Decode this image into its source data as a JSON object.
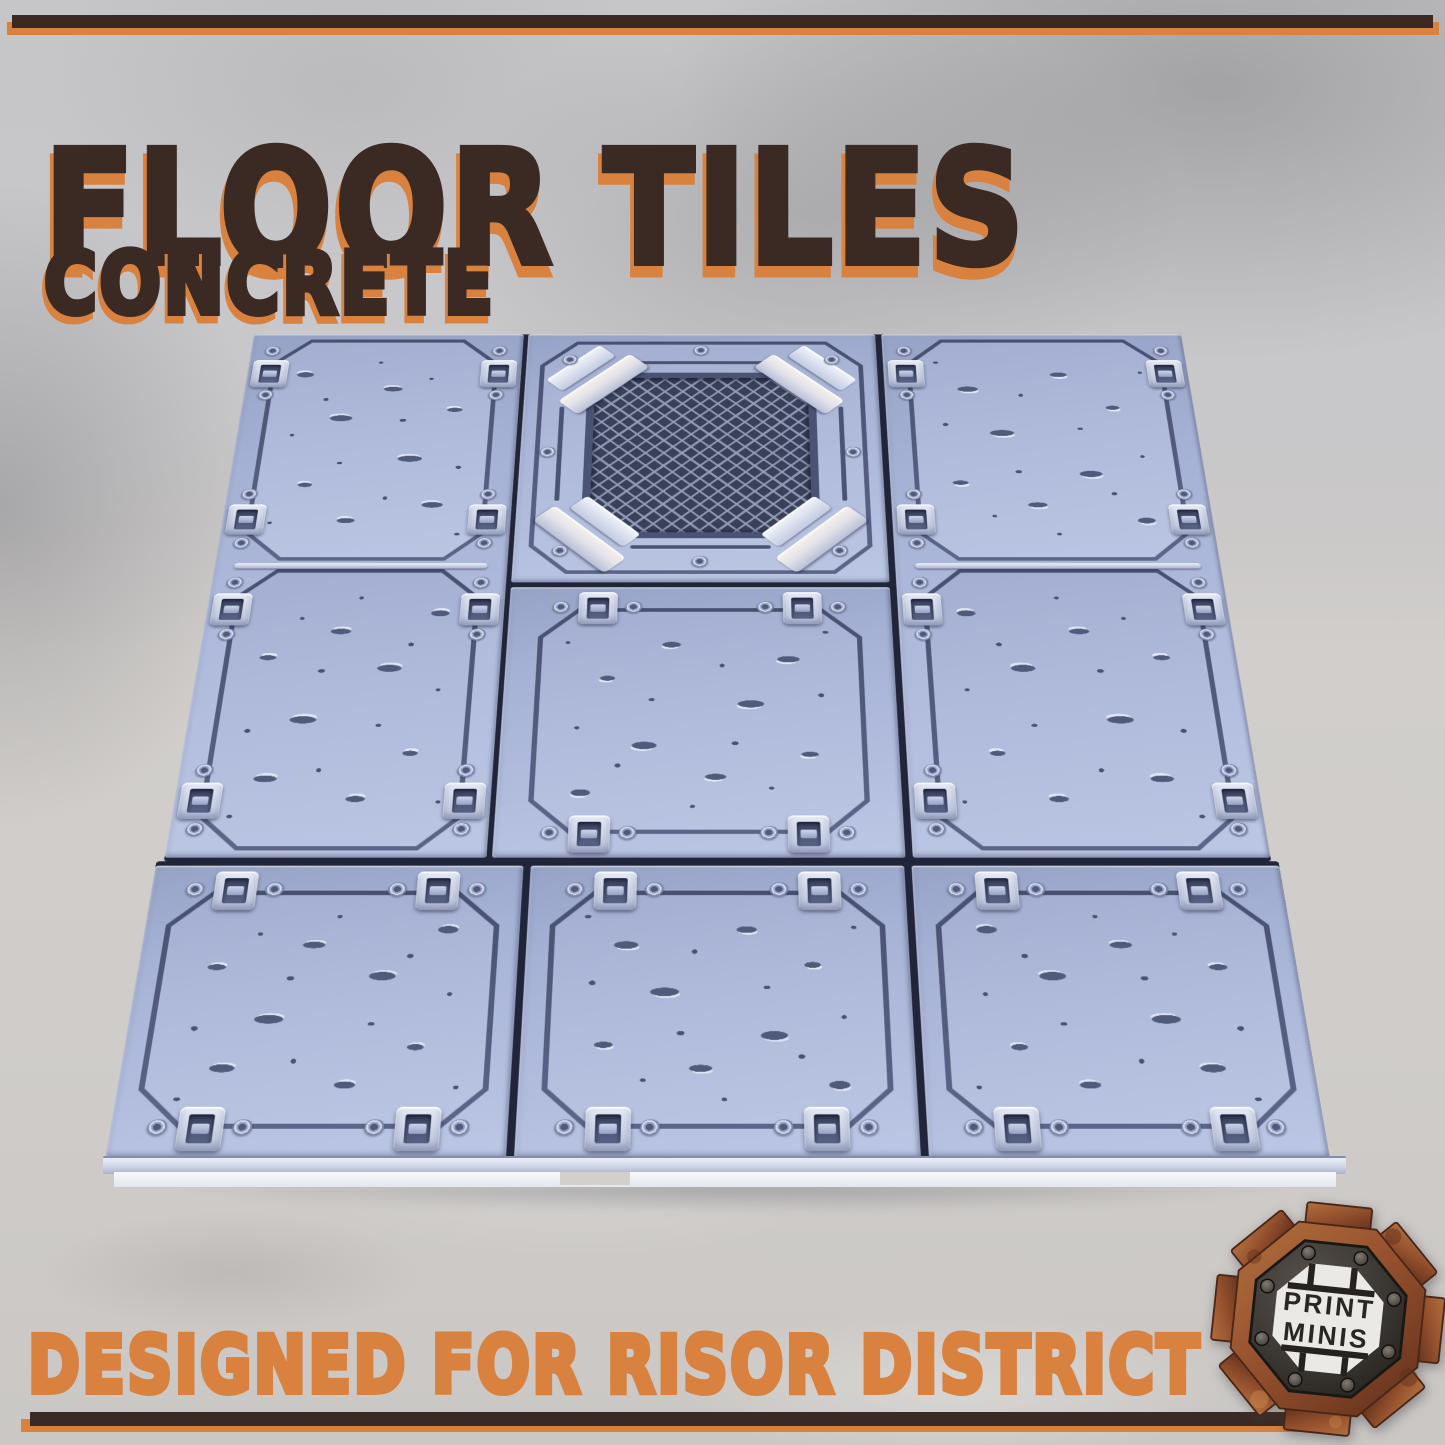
{
  "header": {
    "title": "FLOOR TILES",
    "subtitle": "CONCRETE"
  },
  "footer": {
    "banner": "DESIGNED FOR RISOR DISTRICT"
  },
  "logo": {
    "line1": "PRINT",
    "line2": "MINIS"
  },
  "colors": {
    "accent_orange": "#d9813f",
    "title_brown": "#3a2a23",
    "tile_base": "#aab6d9",
    "tile_groove": "#4e5778",
    "tile_seam": "#20253a",
    "clip_light": "#dde4f2",
    "mesh_dark": "#39405a",
    "mesh_lattice": "#949cb6",
    "logo_rust": "#8f4a28",
    "wall_grey": "#c7c7c9",
    "floor_grey": "#cfccc9"
  },
  "scene": {
    "sections": [
      {
        "x": 8,
        "y": 0,
        "w": 1209,
        "h": 866,
        "tiles": [
          {
            "id": "tile-upper-left",
            "x": 0,
            "y": 0,
            "w": 352,
            "h": 861,
            "rails": [
              414
            ],
            "panels": [
              {
                "x": 30,
                "y": 10,
                "w": 292,
                "h": 400,
                "clips": "lr",
                "fx": "a"
              },
              {
                "x": 30,
                "y": 424,
                "w": 292,
                "h": 427,
                "clips": "lr",
                "fx": "b"
              }
            ]
          },
          {
            "id": "tile-grate",
            "x": 358,
            "y": 0,
            "w": 452,
            "h": 446,
            "grate": true,
            "panels": [
              {
                "x": 18,
                "y": 14,
                "w": 416,
                "h": 418
              }
            ]
          },
          {
            "id": "tile-under-grate",
            "x": 358,
            "y": 454,
            "w": 452,
            "h": 407,
            "panels": [
              {
                "x": 36,
                "y": 34,
                "w": 380,
                "h": 340,
                "clips": "tb",
                "fx": "c"
              }
            ]
          },
          {
            "id": "tile-upper-right",
            "x": 818,
            "y": 0,
            "w": 391,
            "h": 861,
            "rails": [
              414
            ],
            "panels": [
              {
                "x": 30,
                "y": 10,
                "w": 331,
                "h": 400,
                "clips": "lr",
                "fx": "d"
              },
              {
                "x": 30,
                "y": 424,
                "w": 331,
                "h": 427,
                "clips": "lr",
                "fx": "a"
              }
            ]
          }
        ]
      },
      {
        "x": 0,
        "y": 866,
        "w": 1225,
        "h": 374,
        "tiles": [
          {
            "id": "tile-bottom-left",
            "x": 0,
            "y": 6,
            "w": 401,
            "h": 368,
            "panels": [
              {
                "x": 22,
                "y": 34,
                "w": 357,
                "h": 300,
                "clips": "tb",
                "fx": "b"
              }
            ]
          },
          {
            "id": "tile-bottom-center",
            "x": 409,
            "y": 6,
            "w": 407,
            "h": 368,
            "panels": [
              {
                "x": 24,
                "y": 34,
                "w": 359,
                "h": 300,
                "clips": "tb",
                "fx": "d"
              }
            ]
          },
          {
            "id": "tile-bottom-right",
            "x": 824,
            "y": 6,
            "w": 401,
            "h": 368,
            "panels": [
              {
                "x": 22,
                "y": 34,
                "w": 357,
                "h": 300,
                "clips": "tb",
                "fx": "a"
              }
            ]
          }
        ]
      }
    ]
  }
}
